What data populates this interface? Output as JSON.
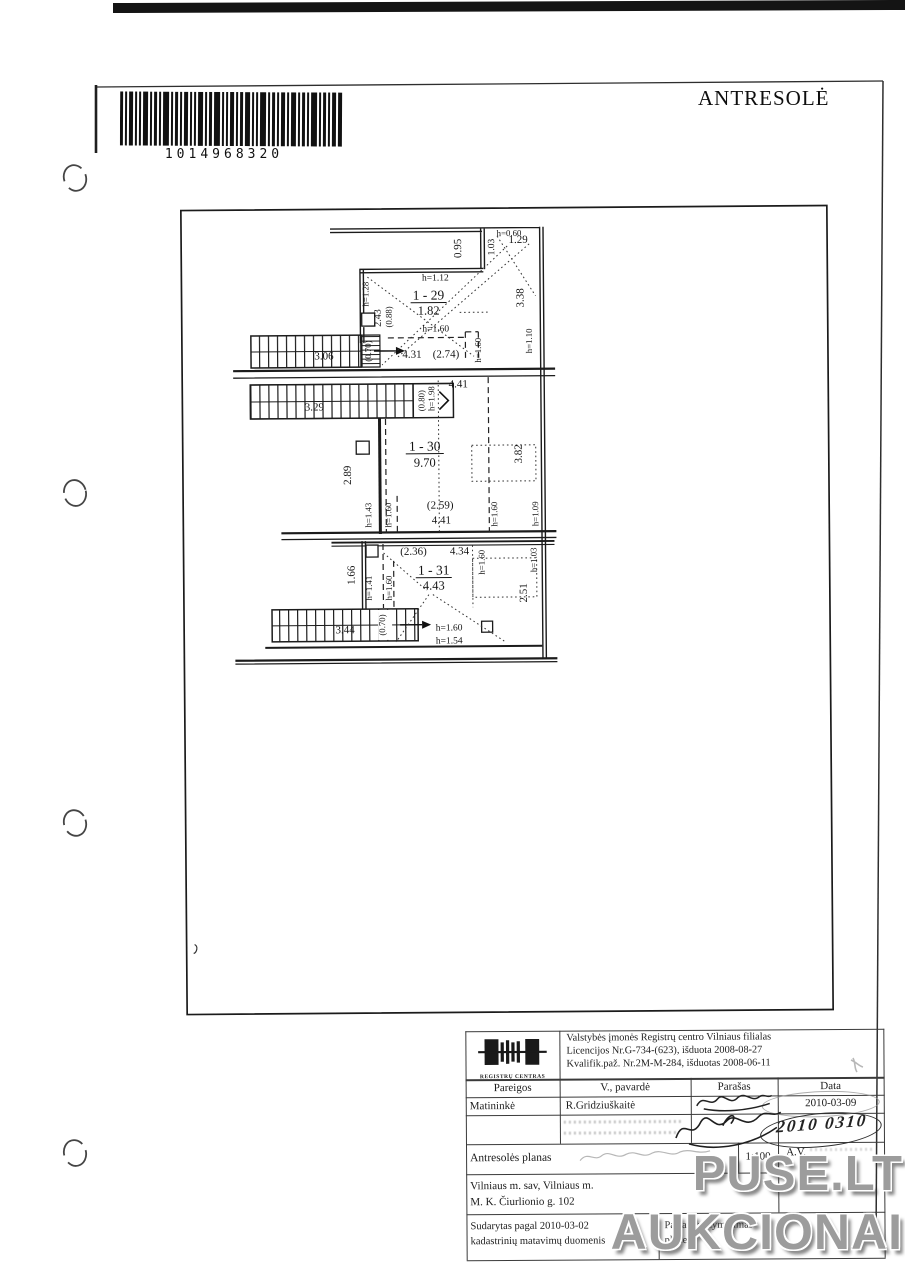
{
  "page": {
    "barcode_number": "1014968320",
    "title": "ANTRESOLĖ"
  },
  "plan": {
    "rooms": [
      {
        "id": "1 - 29",
        "area": "1.82"
      },
      {
        "id": "1 - 30",
        "area": "9.70"
      },
      {
        "id": "1 - 31",
        "area": "4.43"
      }
    ],
    "labels": {
      "v095": "0.95",
      "h060": "h=0.60",
      "v103": "1.03",
      "n129": "1.29",
      "h112": "h=1.12",
      "h128": "h=1.28",
      "v243": "2.43",
      "v088": "(0.88)",
      "h160": "h=1.60",
      "v070": "(0.70)",
      "n306": "3.06",
      "n431": "4.31",
      "n274": "(2.74)",
      "v338": "3.38",
      "h110": "h=1.10",
      "n329": "3.29",
      "v080": "(0.80)",
      "n441": "4.41",
      "h198": "h=1.98",
      "v289": "2.89",
      "v382": "3.82",
      "h143": "h=1.43",
      "n259": "(2.59)",
      "h109": "h=1.09",
      "n236": "(2.36)",
      "n434": "4.34",
      "h103": "h=1.03",
      "v166": "1.66",
      "h141": "h=1.41",
      "v251": "2.51",
      "n344": "3.44",
      "h154": "h=1.54"
    }
  },
  "footer": {
    "logo_caption": "REGISTRŲ CENTRAS",
    "org_lines": [
      "Valstybės įmonės Registrų centro  Vilniaus filialas",
      "Licencijos Nr.G-734-(623), išduota 2008-08-27",
      "Kvalifik.paž. Nr.2M-M-284, išduotas 2008-06-11"
    ],
    "headers": {
      "pareigos": "Pareigos",
      "pavarde": "V., pavardė",
      "parasas": "Parašas",
      "data": "Data"
    },
    "row1": {
      "pareigos": "Matininkė",
      "pavarde": "R.Gridziuškaitė",
      "data": "2010-03-09"
    },
    "stamp_date": "2010 0310",
    "plan_row": {
      "label": "Antresolės planas",
      "scale": "1:100",
      "av": "A.V."
    },
    "address_lines": [
      "Vilniaus m. sav, Vilniaus m.",
      "M. K. Čiurlionio g. 102"
    ],
    "made_lines": [
      "Sudarytas pagal 2010-03-02",
      "kadastrinių matavimų duomenis"
    ],
    "note_lines": [
      "Pastato pažymėjimas",
      "plane"
    ]
  },
  "watermark": {
    "line1": "PUSE.LT",
    "line2": "AUKCIONAI"
  }
}
